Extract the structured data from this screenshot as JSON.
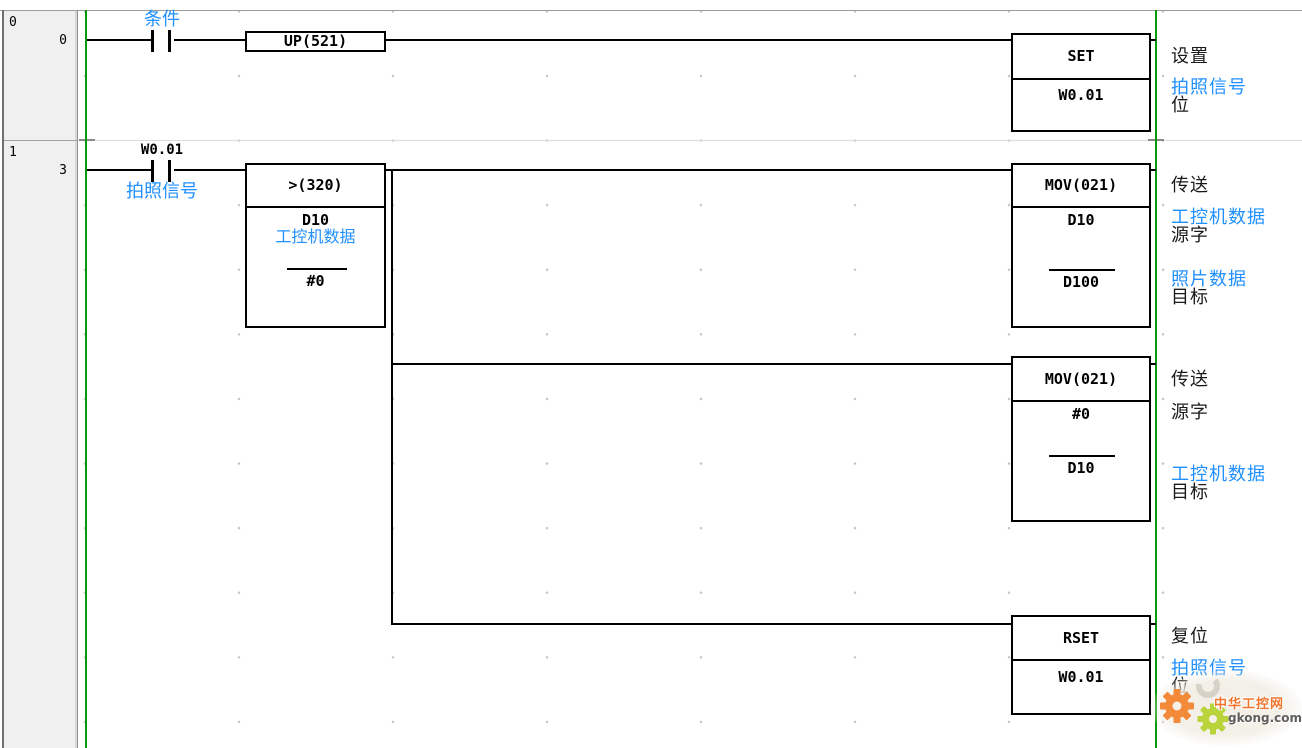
{
  "colors": {
    "bus_green": "#089a08",
    "comment_blue": "#2090ff",
    "wire_black": "#000000",
    "header_gray": "#f0f0f0",
    "watermark_orange": "#f0762e",
    "watermark_green": "#b8d43a"
  },
  "rung0": {
    "number": "0",
    "step": "0",
    "contact": {
      "comment": "条件"
    },
    "up": {
      "mnemonic": "UP(521)"
    },
    "set": {
      "mnemonic": "SET",
      "operand": "W0.01"
    },
    "annot": {
      "op": "设置",
      "bit_comment": "拍照信号",
      "bit_word": "位"
    }
  },
  "rung1": {
    "number": "1",
    "step": "3",
    "contact": {
      "address": "W0.01",
      "comment": "拍照信号"
    },
    "cmp": {
      "mnemonic": ">(320)",
      "op1": "D10",
      "op1_comment": "工控机数据",
      "op2": "#0"
    },
    "mov1": {
      "mnemonic": "MOV(021)",
      "src": "D10",
      "dst": "D100",
      "annot": {
        "op": "传送",
        "src_comment": "工控机数据",
        "src_word": "源字",
        "dst_comment": "照片数据",
        "dst_word": "目标"
      }
    },
    "mov2": {
      "mnemonic": "MOV(021)",
      "src": "#0",
      "dst": "D10",
      "annot": {
        "op": "传送",
        "src_word": "源字",
        "dst_comment": "工控机数据",
        "dst_word": "目标"
      }
    },
    "rset": {
      "mnemonic": "RSET",
      "operand": "W0.01",
      "annot": {
        "op": "复位",
        "bit_comment": "拍照信号",
        "bit_word": "位"
      }
    }
  },
  "watermark": {
    "site_name": "中华工控网",
    "site_domain": "gkong.com"
  }
}
